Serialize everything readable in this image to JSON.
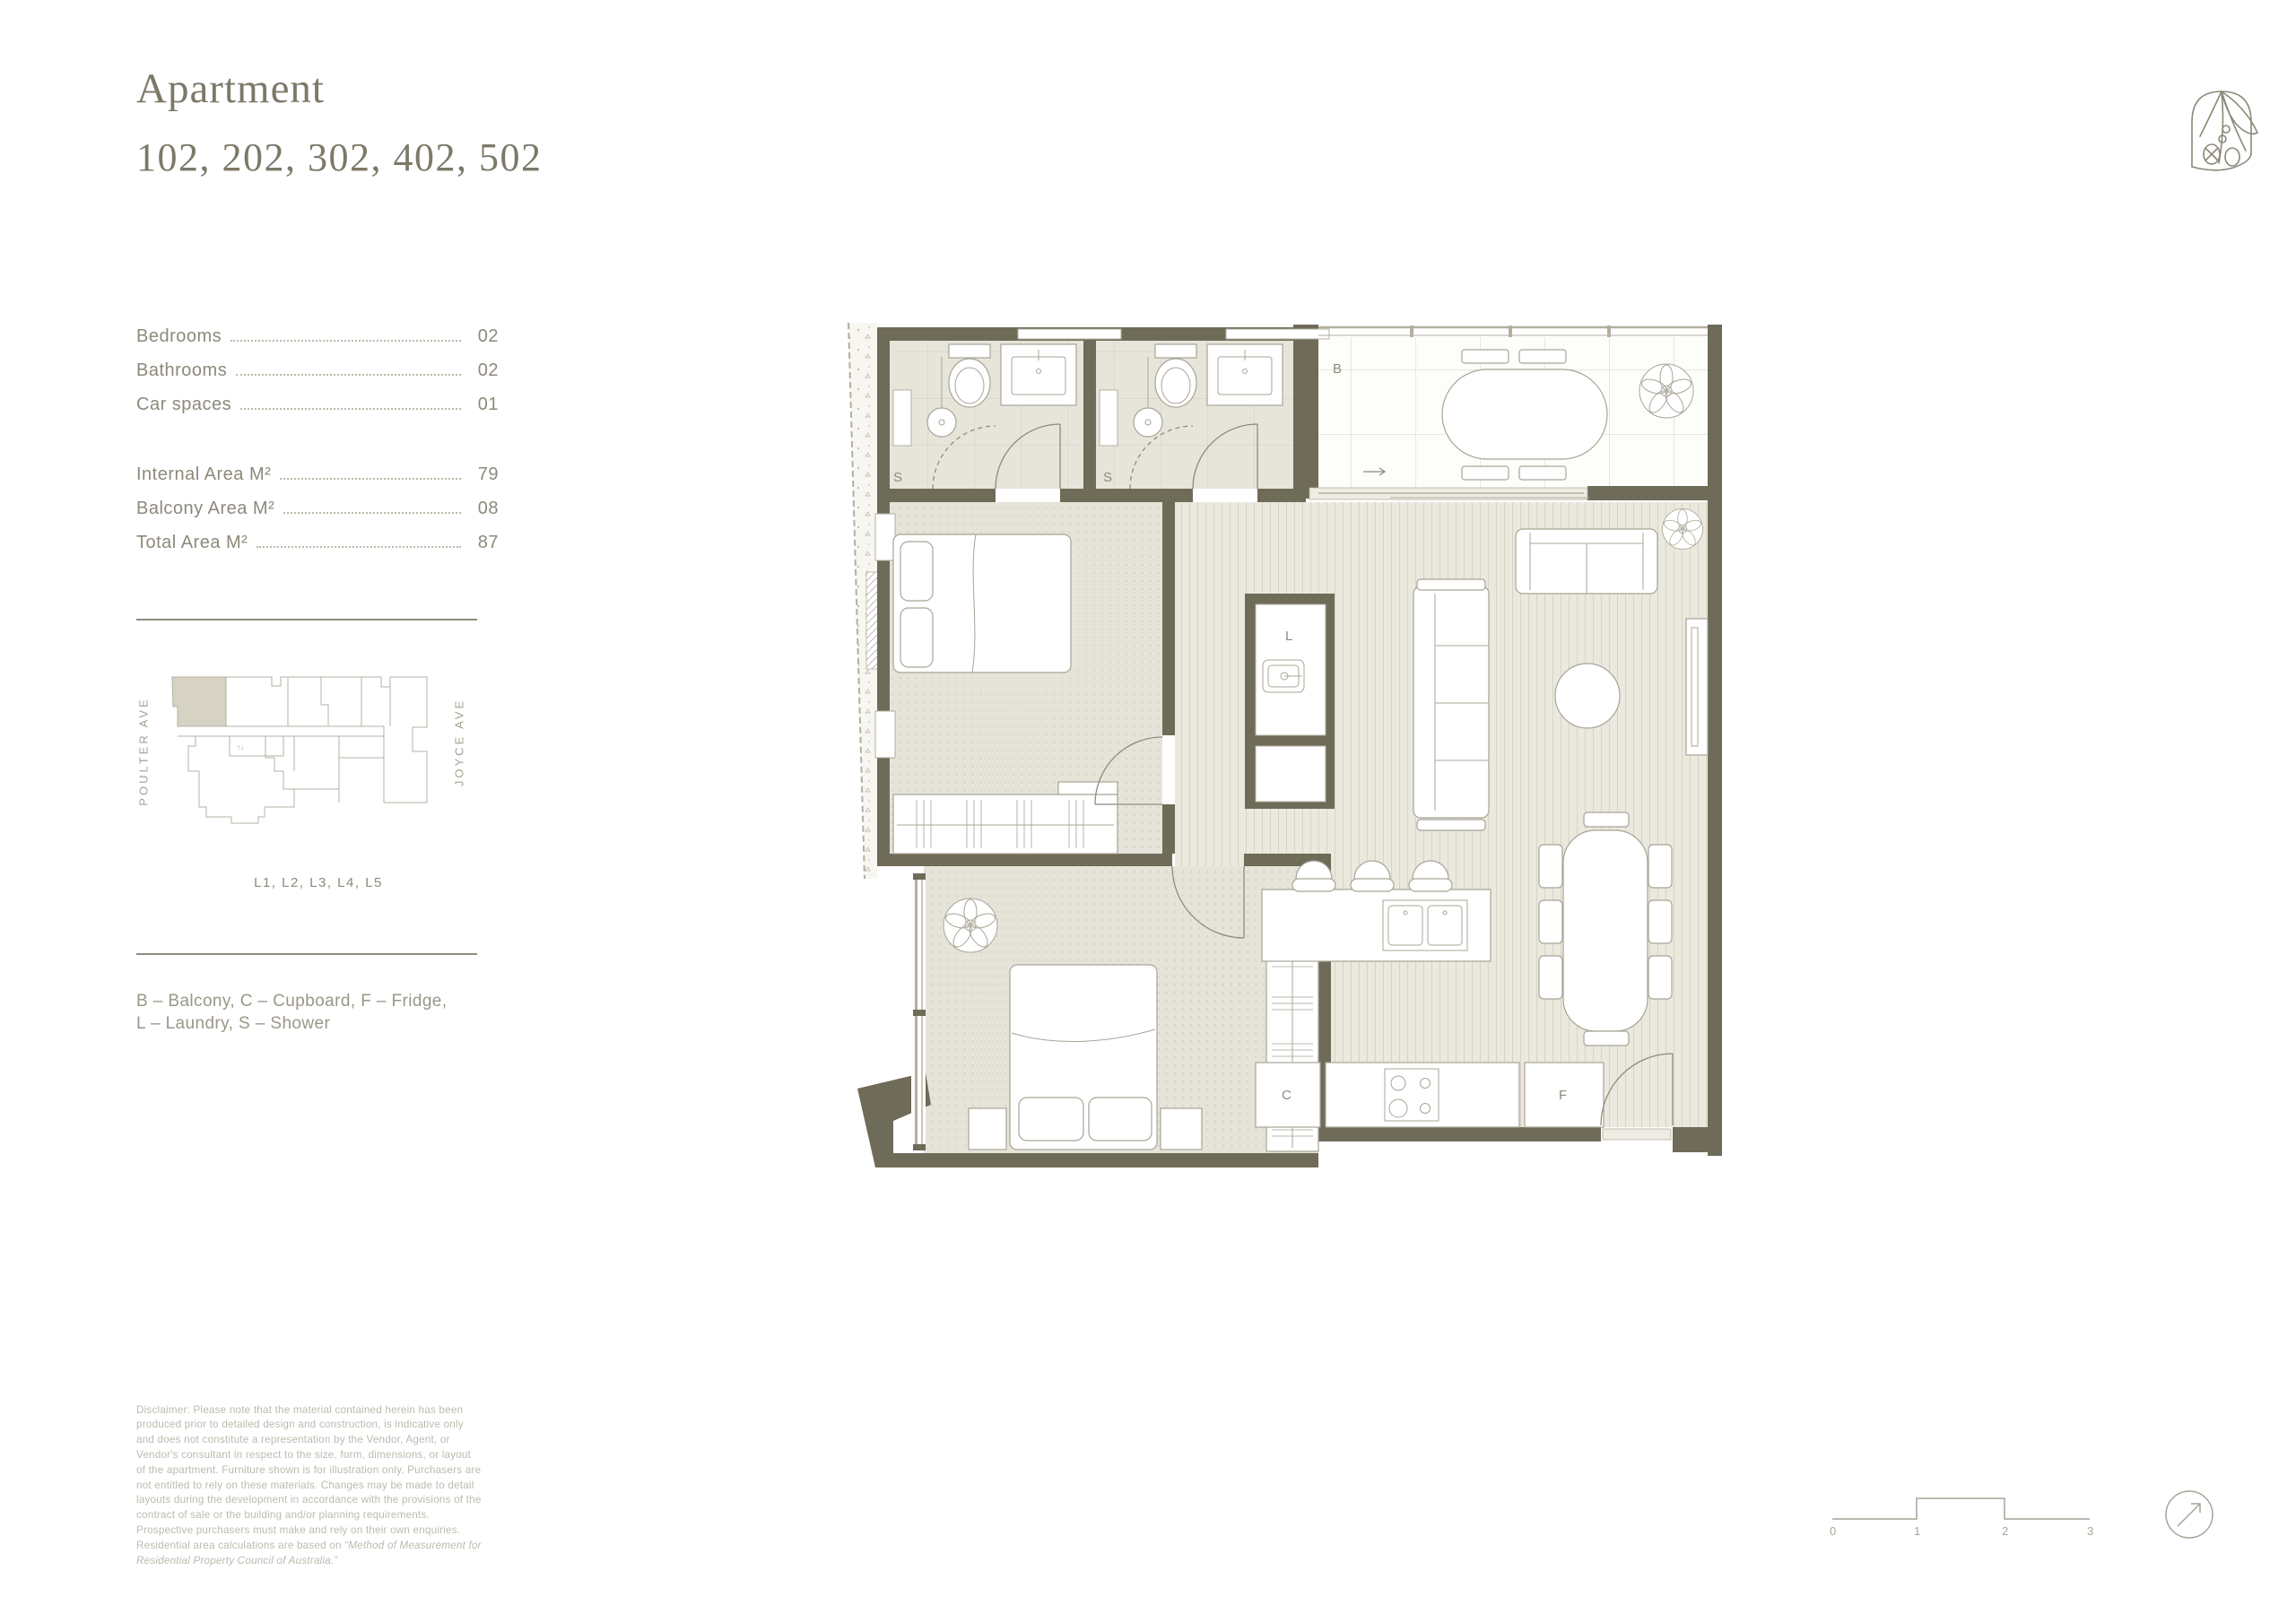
{
  "header": {
    "title": "Apartment",
    "units": "102, 202, 302, 402, 502"
  },
  "stats": {
    "rows": [
      {
        "label": "Bedrooms",
        "value": "02"
      },
      {
        "label": "Bathrooms",
        "value": "02"
      },
      {
        "label": "Car spaces",
        "value": "01"
      },
      {
        "label": "Internal Area M²",
        "value": "79"
      },
      {
        "label": "Balcony Area M²",
        "value": "08"
      },
      {
        "label": "Total Area M²",
        "value": "87"
      }
    ]
  },
  "site_map": {
    "street_left": "POULTER AVE",
    "street_right": "JOYCE AVE",
    "caption": "L1, L2, L3, L4, L5"
  },
  "legend": {
    "line1": "B – Balcony, C – Cupboard, F – Fridge,",
    "line2": "L – Laundry, S – Shower"
  },
  "disclaimer": {
    "text": "Disclaimer: Please note that the material contained herein has been produced prior to detailed design and construction, is indicative only and does not constitute a representation by the Vendor, Agent, or Vendor's consultant in respect to the size, form, dimensions, or layout of the apartment. Furniture shown is for illustration only. Purchasers are not entitled to rely on these materials. Changes may be made to detail layouts during the development in accordance with the provisions of the contract of sale or the building and/or planning requirements. Prospective purchasers must make and rely on their own enquiries. Residential area calculations are based on ",
    "quote": "“Method of Measurement for Residential Property Council of Australia.”"
  },
  "plan": {
    "labels": {
      "balcony": "B",
      "shower_1": "S",
      "shower_2": "S",
      "laundry": "L",
      "cupboard": "C",
      "fridge": "F"
    }
  },
  "scale_bar": {
    "ticks": [
      "0",
      "1",
      "2",
      "3"
    ]
  },
  "colors": {
    "wall": "#6f6b59",
    "floor_tile": "#e7e5da",
    "floor_timber": "#ebe9de",
    "carpet": "#e6e4d9",
    "highlight": "#d6d3c4",
    "ink": "#8d897b",
    "ink_light": "#bdbaae",
    "line": "#a8a496"
  }
}
